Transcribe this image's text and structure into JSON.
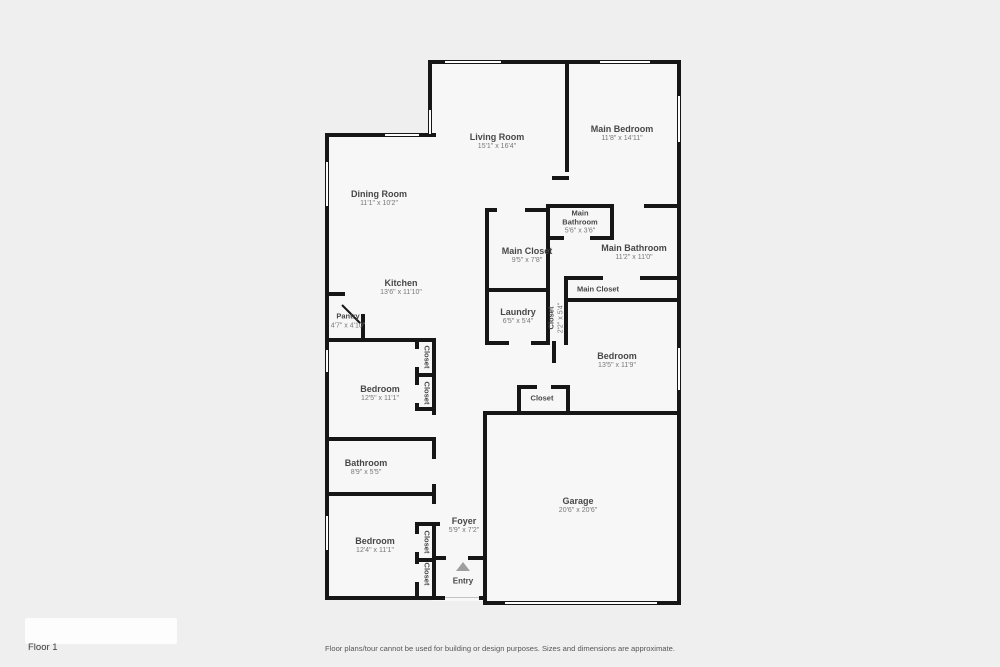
{
  "floorplan": {
    "floor_label": "Floor 1",
    "disclaimer": "Floor plans/tour cannot be used for building or design purposes. Sizes and dimensions are approximate.",
    "entry_label": "Entry",
    "colors": {
      "background": "#efefef",
      "room_fill": "#f7f7f7",
      "wall": "#161616",
      "label_text": "#474747"
    },
    "rooms": [
      {
        "name": "Living Room",
        "dims": "15'1\" x 16'4\""
      },
      {
        "name": "Main Bedroom",
        "dims": "11'8\" x 14'11\""
      },
      {
        "name": "Dining Room",
        "dims": "11'1\" x 10'2\""
      },
      {
        "name": "Main Bathroom",
        "dims": "5'6\" x 3'6\""
      },
      {
        "name": "Main Closet",
        "dims": "9'5\" x 7'8\""
      },
      {
        "name": "Main Bathroom",
        "dims": "11'2\" x 11'0\""
      },
      {
        "name": "Main Closet",
        "dims": ""
      },
      {
        "name": "Kitchen",
        "dims": "13'6\" x 11'10\""
      },
      {
        "name": "Pantry",
        "dims": "4'7\" x 4'10\""
      },
      {
        "name": "Laundry",
        "dims": "6'5\" x 5'4\""
      },
      {
        "name": "Closet",
        "dims": "2'2\" x 5'4\""
      },
      {
        "name": "Bedroom",
        "dims": "12'5\" x 11'1\""
      },
      {
        "name": "Closet",
        "dims": ""
      },
      {
        "name": "Closet",
        "dims": ""
      },
      {
        "name": "Bedroom",
        "dims": "13'5\" x 11'9\""
      },
      {
        "name": "Closet",
        "dims": ""
      },
      {
        "name": "Bathroom",
        "dims": "8'9\" x 5'5\""
      },
      {
        "name": "Bedroom",
        "dims": "12'4\" x 11'1\""
      },
      {
        "name": "Closet",
        "dims": ""
      },
      {
        "name": "Closet",
        "dims": ""
      },
      {
        "name": "Foyer",
        "dims": "5'9\" x 7'2\""
      },
      {
        "name": "Garage",
        "dims": "20'6\" x 20'6\""
      }
    ]
  }
}
